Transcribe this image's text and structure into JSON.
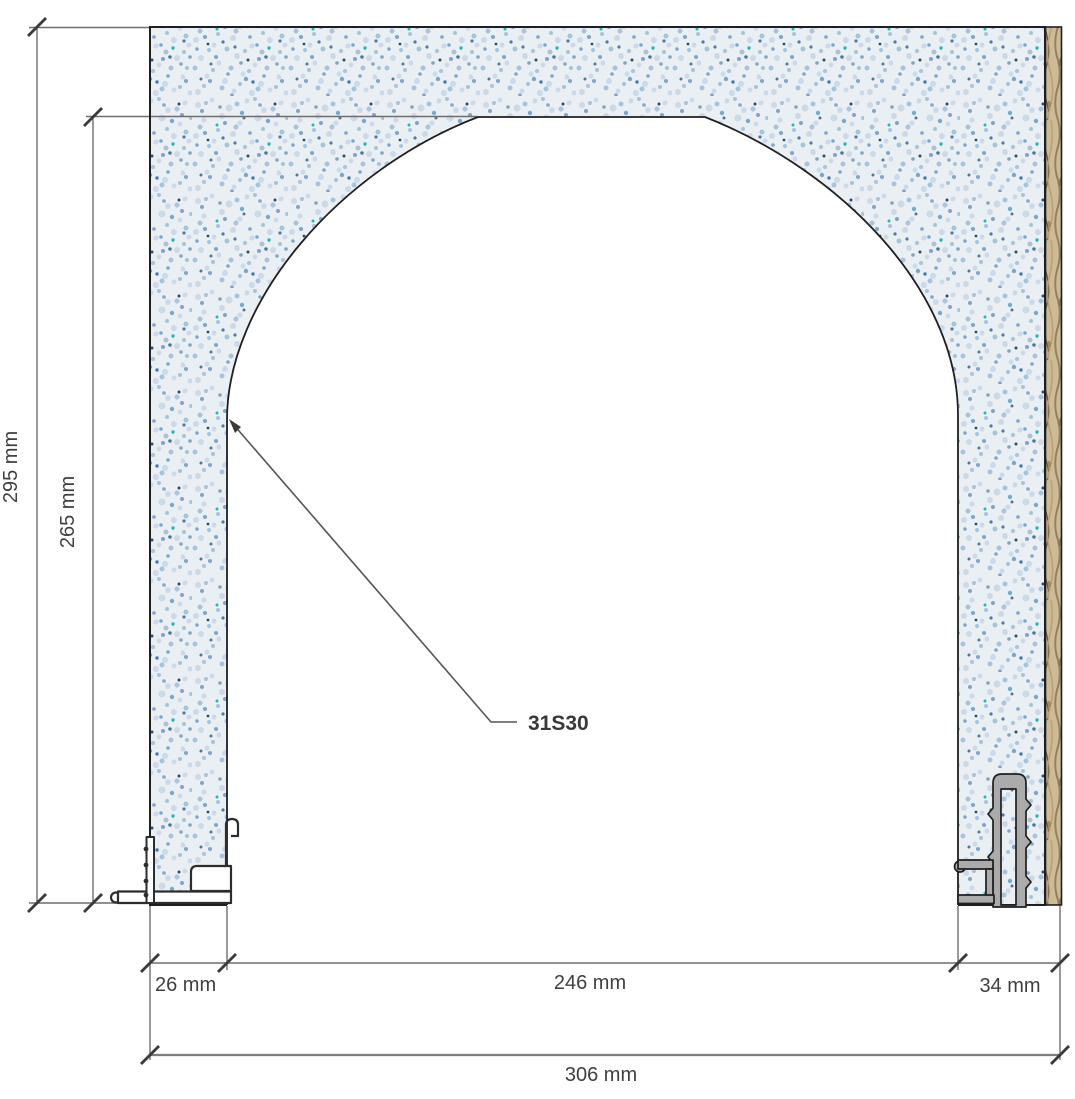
{
  "drawing": {
    "type": "technical-section-detail",
    "part_label": "31S30",
    "dimensions": {
      "total_height": "295 mm",
      "opening_height": "265 mm",
      "left_leg_width": "26 mm",
      "opening_width": "246 mm",
      "right_leg_width": "34 mm",
      "total_width": "306 mm"
    },
    "colors": {
      "panel_base": "#eaeff4",
      "panel_speckle": "#7fa6c6",
      "wood_edge": "#cdbb97",
      "outline": "#1f1f1f",
      "dimension_line": "#6e6e6e",
      "tick": "#3a3a3a",
      "text": "#3f3f3f"
    }
  }
}
